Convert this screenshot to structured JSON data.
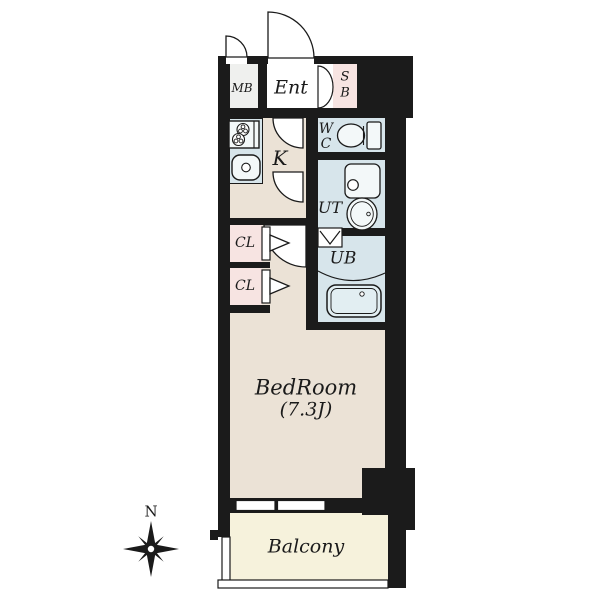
{
  "title": "apartment-floor-plan",
  "rooms": {
    "meter_box": {
      "label": "MB"
    },
    "entrance": {
      "label": "Ent"
    },
    "shoe_box": {
      "lines": [
        "S",
        "B"
      ]
    },
    "kitchen": {
      "label": "K"
    },
    "toilet": {
      "lines": [
        "W",
        "C"
      ]
    },
    "utility": {
      "label": "UT"
    },
    "unit_bath": {
      "label": "UB"
    },
    "closet_1": {
      "label": "CL"
    },
    "closet_2": {
      "label": "CL"
    },
    "bedroom": {
      "label": "BedRoom",
      "size": "(7.3J)"
    },
    "balcony": {
      "label": "Balcony"
    }
  },
  "compass": {
    "north_label": "N"
  },
  "icons": [
    "stove-icon",
    "kitchen-sink-icon",
    "toilet-icon",
    "washing-machine-icon",
    "utility-sink-icon",
    "bathtub-icon",
    "door-swing-icon",
    "folding-door-icon",
    "compass-north-icon",
    "window-icon"
  ],
  "colors": {
    "wall": "#1b1b1b",
    "line": "#1a1a1a",
    "room_beige": "#ebe2d6",
    "room_blue": "#d7e5eb",
    "room_pink": "#f7e4e2",
    "room_white": "#fdfdfc",
    "mb_gray": "#eff0ee",
    "balcony_yellow": "#f6f2dc",
    "fixture": "#f3f8f9",
    "tub": "#e2eef2"
  }
}
